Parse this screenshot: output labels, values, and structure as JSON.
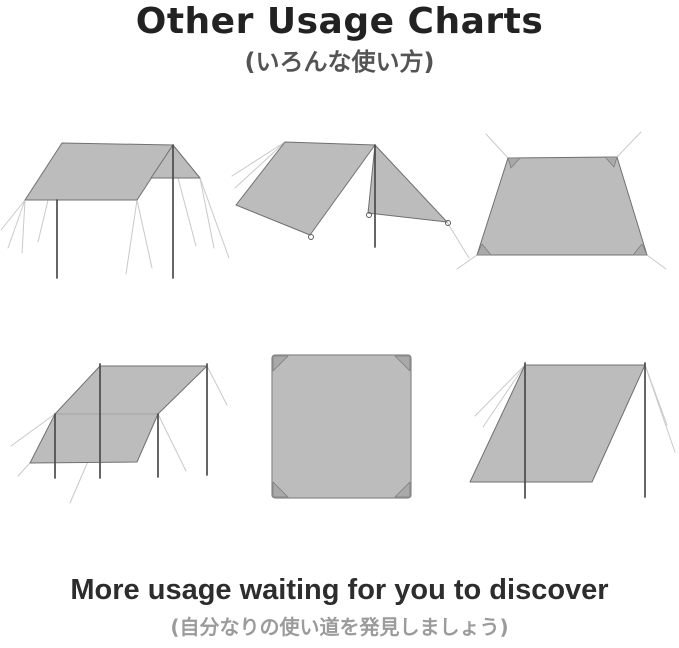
{
  "header": {
    "title": "Other Usage Charts",
    "subtitle_jp": "(いろんな使い方)"
  },
  "footer": {
    "heading": "More usage waiting for you to discover",
    "subtitle_jp": "(自分なりの使い道を発見しましょう)"
  },
  "diagrams": [
    {
      "name": "flat-canopy-tarp-two-poles"
    },
    {
      "name": "a-frame-tarp-shelter"
    },
    {
      "name": "trapezoid-ground-sheet"
    },
    {
      "name": "awning-tarp-four-poles"
    },
    {
      "name": "flat-square-tarp"
    },
    {
      "name": "lean-to-windbreak-tarp"
    }
  ],
  "colors": {
    "page_bg": "#ffffff",
    "tarp_fill": "#bcbcbc",
    "tarp_stroke": "#707070",
    "pole": "#4b4b4b",
    "guy_line": "#c9c9c9",
    "title_text": "#222222",
    "subtitle_text": "#545454",
    "footer_heading_text": "#2d2d2d",
    "footer_subtitle_text": "#9b9b9b"
  }
}
